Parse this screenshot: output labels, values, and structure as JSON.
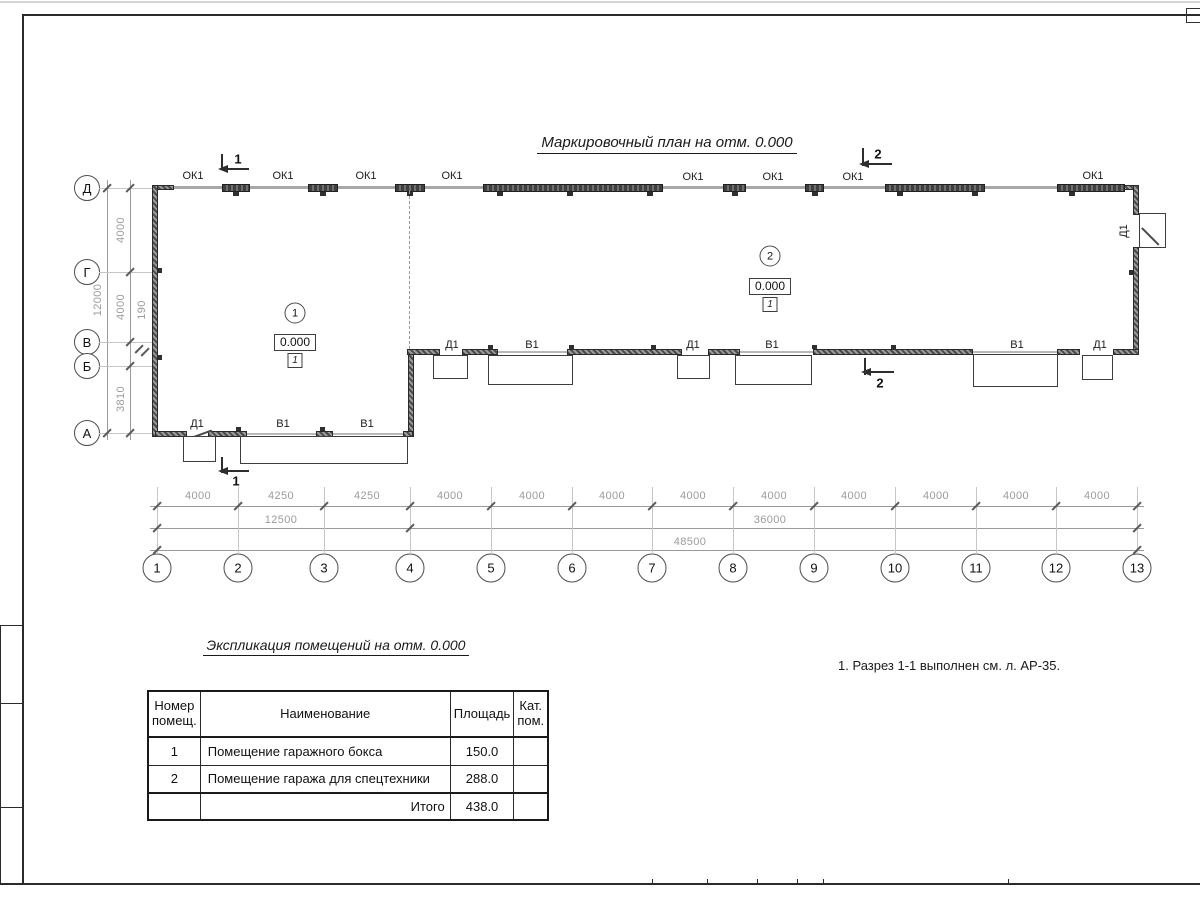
{
  "title": "Маркировочный план на отм. 0.000",
  "plan": {
    "ok_labels": [
      "ОК1",
      "ОК1",
      "ОК1",
      "ОК1",
      "ОК1",
      "ОК1",
      "ОК1",
      "ОК1"
    ],
    "south_room1_labels": [
      "Д1",
      "В1",
      "В1"
    ],
    "south_room2_labels": [
      "Д1",
      "В1",
      "Д1",
      "В1",
      "В1",
      "Д1"
    ],
    "east_door_label": "Д1",
    "rooms": [
      {
        "number": "1",
        "elevation": "0.000",
        "floor_type": "1"
      },
      {
        "number": "2",
        "elevation": "0.000",
        "floor_type": "1"
      }
    ],
    "sections": {
      "s1": "1",
      "s2": "2"
    }
  },
  "grid": {
    "letters": [
      "Д",
      "Г",
      "В",
      "Б",
      "А"
    ],
    "numbers": [
      "1",
      "2",
      "3",
      "4",
      "5",
      "6",
      "7",
      "8",
      "9",
      "10",
      "11",
      "12",
      "13"
    ]
  },
  "dimensions": {
    "left_spans": [
      "4000",
      "4000",
      "190",
      "3810"
    ],
    "left_total": "12000",
    "bottom_spans": [
      "4000",
      "4250",
      "4250",
      "4000",
      "4000",
      "4000",
      "4000",
      "4000",
      "4000",
      "4000",
      "4000",
      "4000"
    ],
    "bottom_intermediate": [
      "12500",
      "36000"
    ],
    "bottom_total": "48500"
  },
  "schedule": {
    "title": "Экспликация помещений на отм. 0.000",
    "headers": {
      "number": "Номер помещ.",
      "name": "Наименование",
      "area": "Площадь",
      "category": "Кат. пом."
    },
    "rows": [
      {
        "number": "1",
        "name": "Помещение гаражного бокса",
        "area": "150.0",
        "category": ""
      },
      {
        "number": "2",
        "name": "Помещение гаража для спецтехники",
        "area": "288.0",
        "category": ""
      }
    ],
    "total_label": "Итого",
    "total_area": "438.0"
  },
  "note": "1. Разрез 1-1 выполнен см. л. АР-35.",
  "colors": {
    "ink": "#1f1f1f",
    "dim_line": "#9a9a9a",
    "wall_fill": "#555555"
  }
}
